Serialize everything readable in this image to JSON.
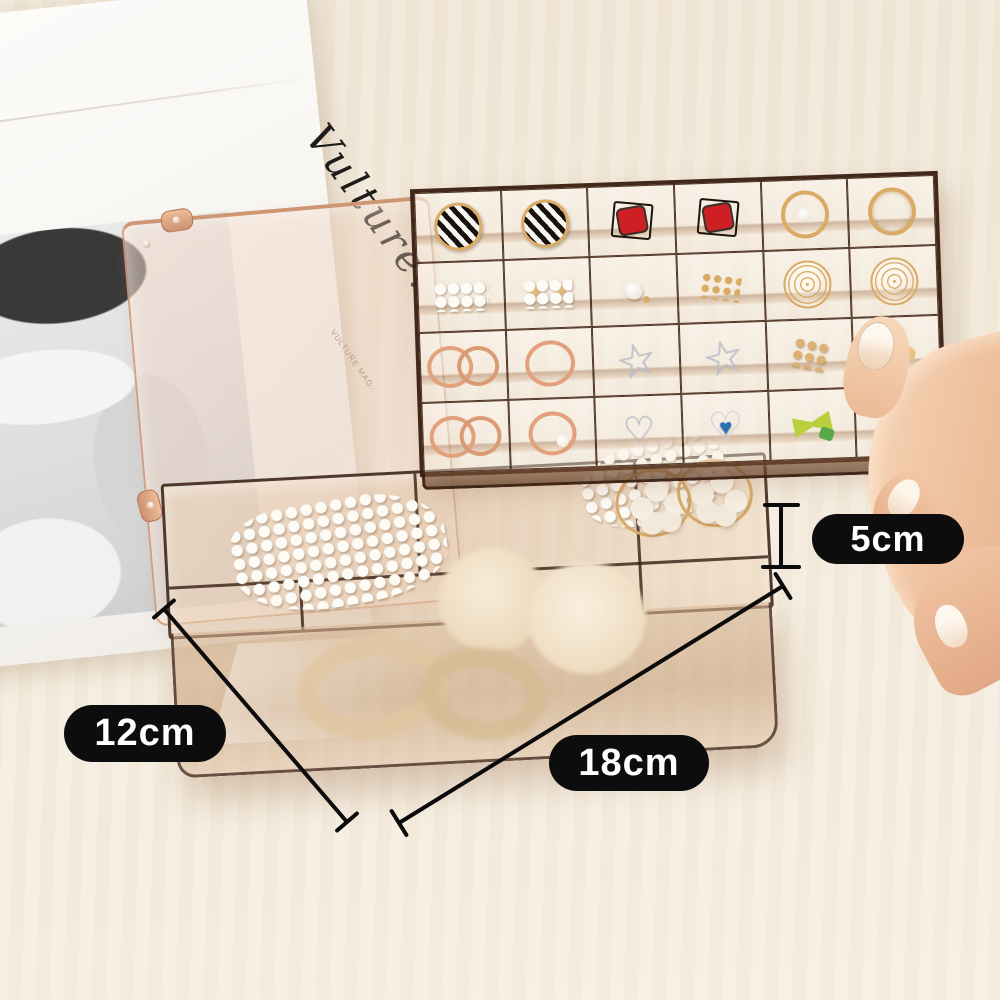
{
  "labels": {
    "height": "5cm",
    "width": "12cm",
    "length": "18cm"
  },
  "magazine": {
    "script_title": "Vulture.",
    "caption": "VULTURE MAG."
  },
  "colors": {
    "background": "#f1e8da",
    "dimension_pill_bg": "#0d0d0d",
    "dimension_pill_text": "#ffffff",
    "dimension_line": "#0b0b0b",
    "tray_frame_brown": "#38200f",
    "box_amber_tint": "#c99a72",
    "lid_copper_edge": "#cd9270",
    "hand_skin": "#eab792",
    "pearl_white": "#fdfbf6",
    "earring_red": "#ce1f24",
    "gold": "#d9ab66",
    "rose_gold": "#e2a07c",
    "silver": "#c2c6d1",
    "leaf_green": "#5fae4a",
    "bow_yellow_green": "#b9cf3e",
    "gem_blue": "#2a6fb0"
  },
  "tray": {
    "rows": 4,
    "columns": 6,
    "cells": [
      [
        "striped-circle-earring",
        "striped-circle-earring",
        "red-square-earring",
        "red-square-earring",
        "gold-hoop-pearl-earring",
        "gold-hoop-earring"
      ],
      [
        "pearl-cluster",
        "pearl-gold-cluster",
        "pearl-stud-earring",
        "gold-stud-earrings",
        "gold-wire-ball-earring",
        "gold-wire-ball-earring"
      ],
      [
        "rose-gold-hoops",
        "rose-gold-hoop",
        "silver-star-earring",
        "silver-star-earring",
        "gold-drop-earrings",
        "gold-flower-earring"
      ],
      [
        "rose-gold-hoops",
        "rose-gold-hoop-pearl",
        "silver-heart-earring",
        "blue-gem-heart-earring",
        "green-bow-earring",
        "green-clover-earring"
      ]
    ]
  },
  "box": {
    "items": [
      "pearl-hair-clip",
      "pearl-hair-clip",
      "white-flower-hair-tie",
      "white-flower-hair-tie",
      "fur-pompom",
      "fur-pompom",
      "beige-scrunchie",
      "beige-scrunchie"
    ]
  }
}
